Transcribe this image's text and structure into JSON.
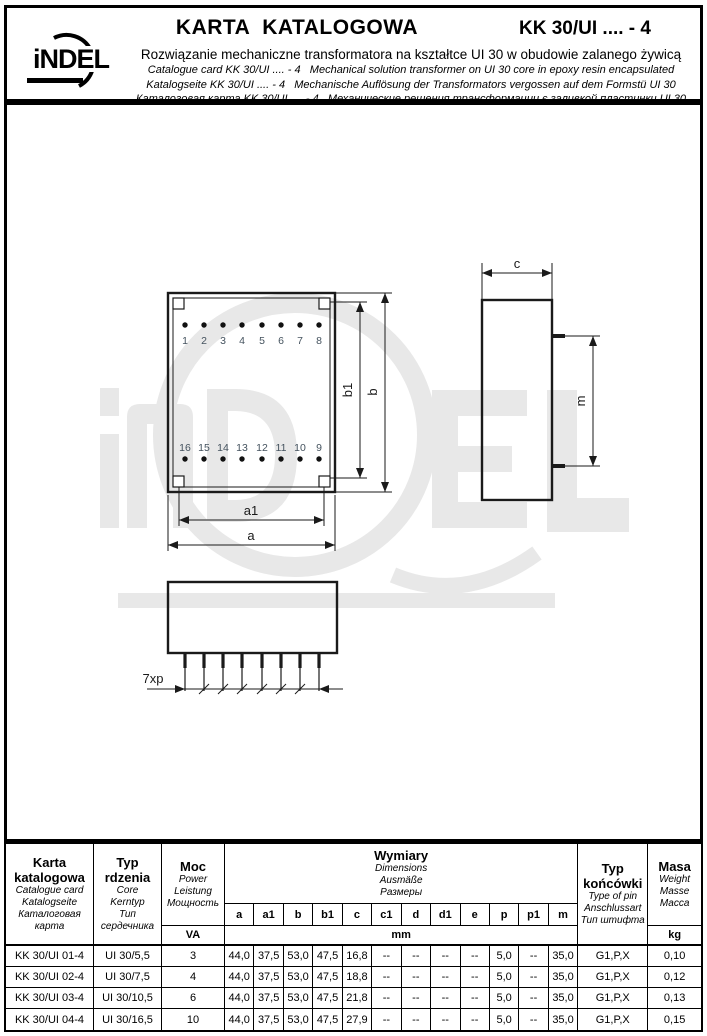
{
  "header": {
    "logo": "iNDEL",
    "title": "KARTA  KATALOGOWA",
    "code": "KK 30/UI .... - 4",
    "line_pl": "Rozwiązanie mechaniczne transformatora na kształtce UI 30 w obudowie zalanego żywicą",
    "line_en": "Catalogue card KK 30/UI .... - 4   Mechanical solution transformer on UI 30 core in epoxy resin encapsulated",
    "line_de": "Katalogseite KK 30/UI .... - 4   Mechanische Auflösung der Transformators vergossen auf dem Formstü UI 30",
    "line_ru": "Каталоговая карта KK 30/UI .... - 4   Механические решения трансформации є заливкой пластинки UI 30"
  },
  "drawing": {
    "pins_top": [
      "1",
      "2",
      "3",
      "4",
      "5",
      "6",
      "7",
      "8"
    ],
    "pins_bottom": [
      "16",
      "15",
      "14",
      "13",
      "12",
      "11",
      "10",
      "9"
    ],
    "dim_a": "a",
    "dim_a1": "a1",
    "dim_b": "b",
    "dim_b1": "b1",
    "dim_c": "c",
    "dim_m": "m",
    "dim_pitch": "7xp"
  },
  "table": {
    "col_card": {
      "t1": "Karta",
      "t2": "katalogowa",
      "en": "Catalogue card",
      "de": "Katalogseite",
      "ru1": "Каталоговая",
      "ru2": "карта"
    },
    "col_core": {
      "t1": "Typ",
      "t2": "rdzenia",
      "en": "Core",
      "de": "Kerntyp",
      "ru1": "Тип",
      "ru2": "сердечника"
    },
    "col_power": {
      "t1": "Moc",
      "en": "Power",
      "de": "Leistung",
      "ru": "Мощность",
      "unit": "VA"
    },
    "col_dims": {
      "t1": "Wymiary",
      "en": "Dimensions",
      "de": "Ausmäße",
      "ru": "Размеры",
      "unit": "mm",
      "subs": [
        "a",
        "a1",
        "b",
        "b1",
        "c",
        "c1",
        "d",
        "d1",
        "e",
        "p",
        "p1",
        "m"
      ]
    },
    "col_pin": {
      "t1": "Typ",
      "t2": "końcówki",
      "en": "Type of pin",
      "de": "Anschlussart",
      "ru": "Тип штифта"
    },
    "col_mass": {
      "t1": "Masa",
      "en": "Weight",
      "de": "Masse",
      "ru": "Масса",
      "unit": "kg"
    },
    "rows": [
      [
        "KK 30/UI 01-4",
        "UI 30/5,5",
        "3",
        "44,0",
        "37,5",
        "53,0",
        "47,5",
        "16,8",
        "--",
        "--",
        "--",
        "--",
        "5,0",
        "--",
        "35,0",
        "G1,P,X",
        "0,10"
      ],
      [
        "KK 30/UI 02-4",
        "UI 30/7,5",
        "4",
        "44,0",
        "37,5",
        "53,0",
        "47,5",
        "18,8",
        "--",
        "--",
        "--",
        "--",
        "5,0",
        "--",
        "35,0",
        "G1,P,X",
        "0,12"
      ],
      [
        "KK 30/UI 03-4",
        "UI 30/10,5",
        "6",
        "44,0",
        "37,5",
        "53,0",
        "47,5",
        "21,8",
        "--",
        "--",
        "--",
        "--",
        "5,0",
        "--",
        "35,0",
        "G1,P,X",
        "0,13"
      ],
      [
        "KK 30/UI 04-4",
        "UI 30/16,5",
        "10",
        "44,0",
        "37,5",
        "53,0",
        "47,5",
        "27,9",
        "--",
        "--",
        "--",
        "--",
        "5,0",
        "--",
        "35,0",
        "G1,P,X",
        "0,15"
      ]
    ]
  }
}
